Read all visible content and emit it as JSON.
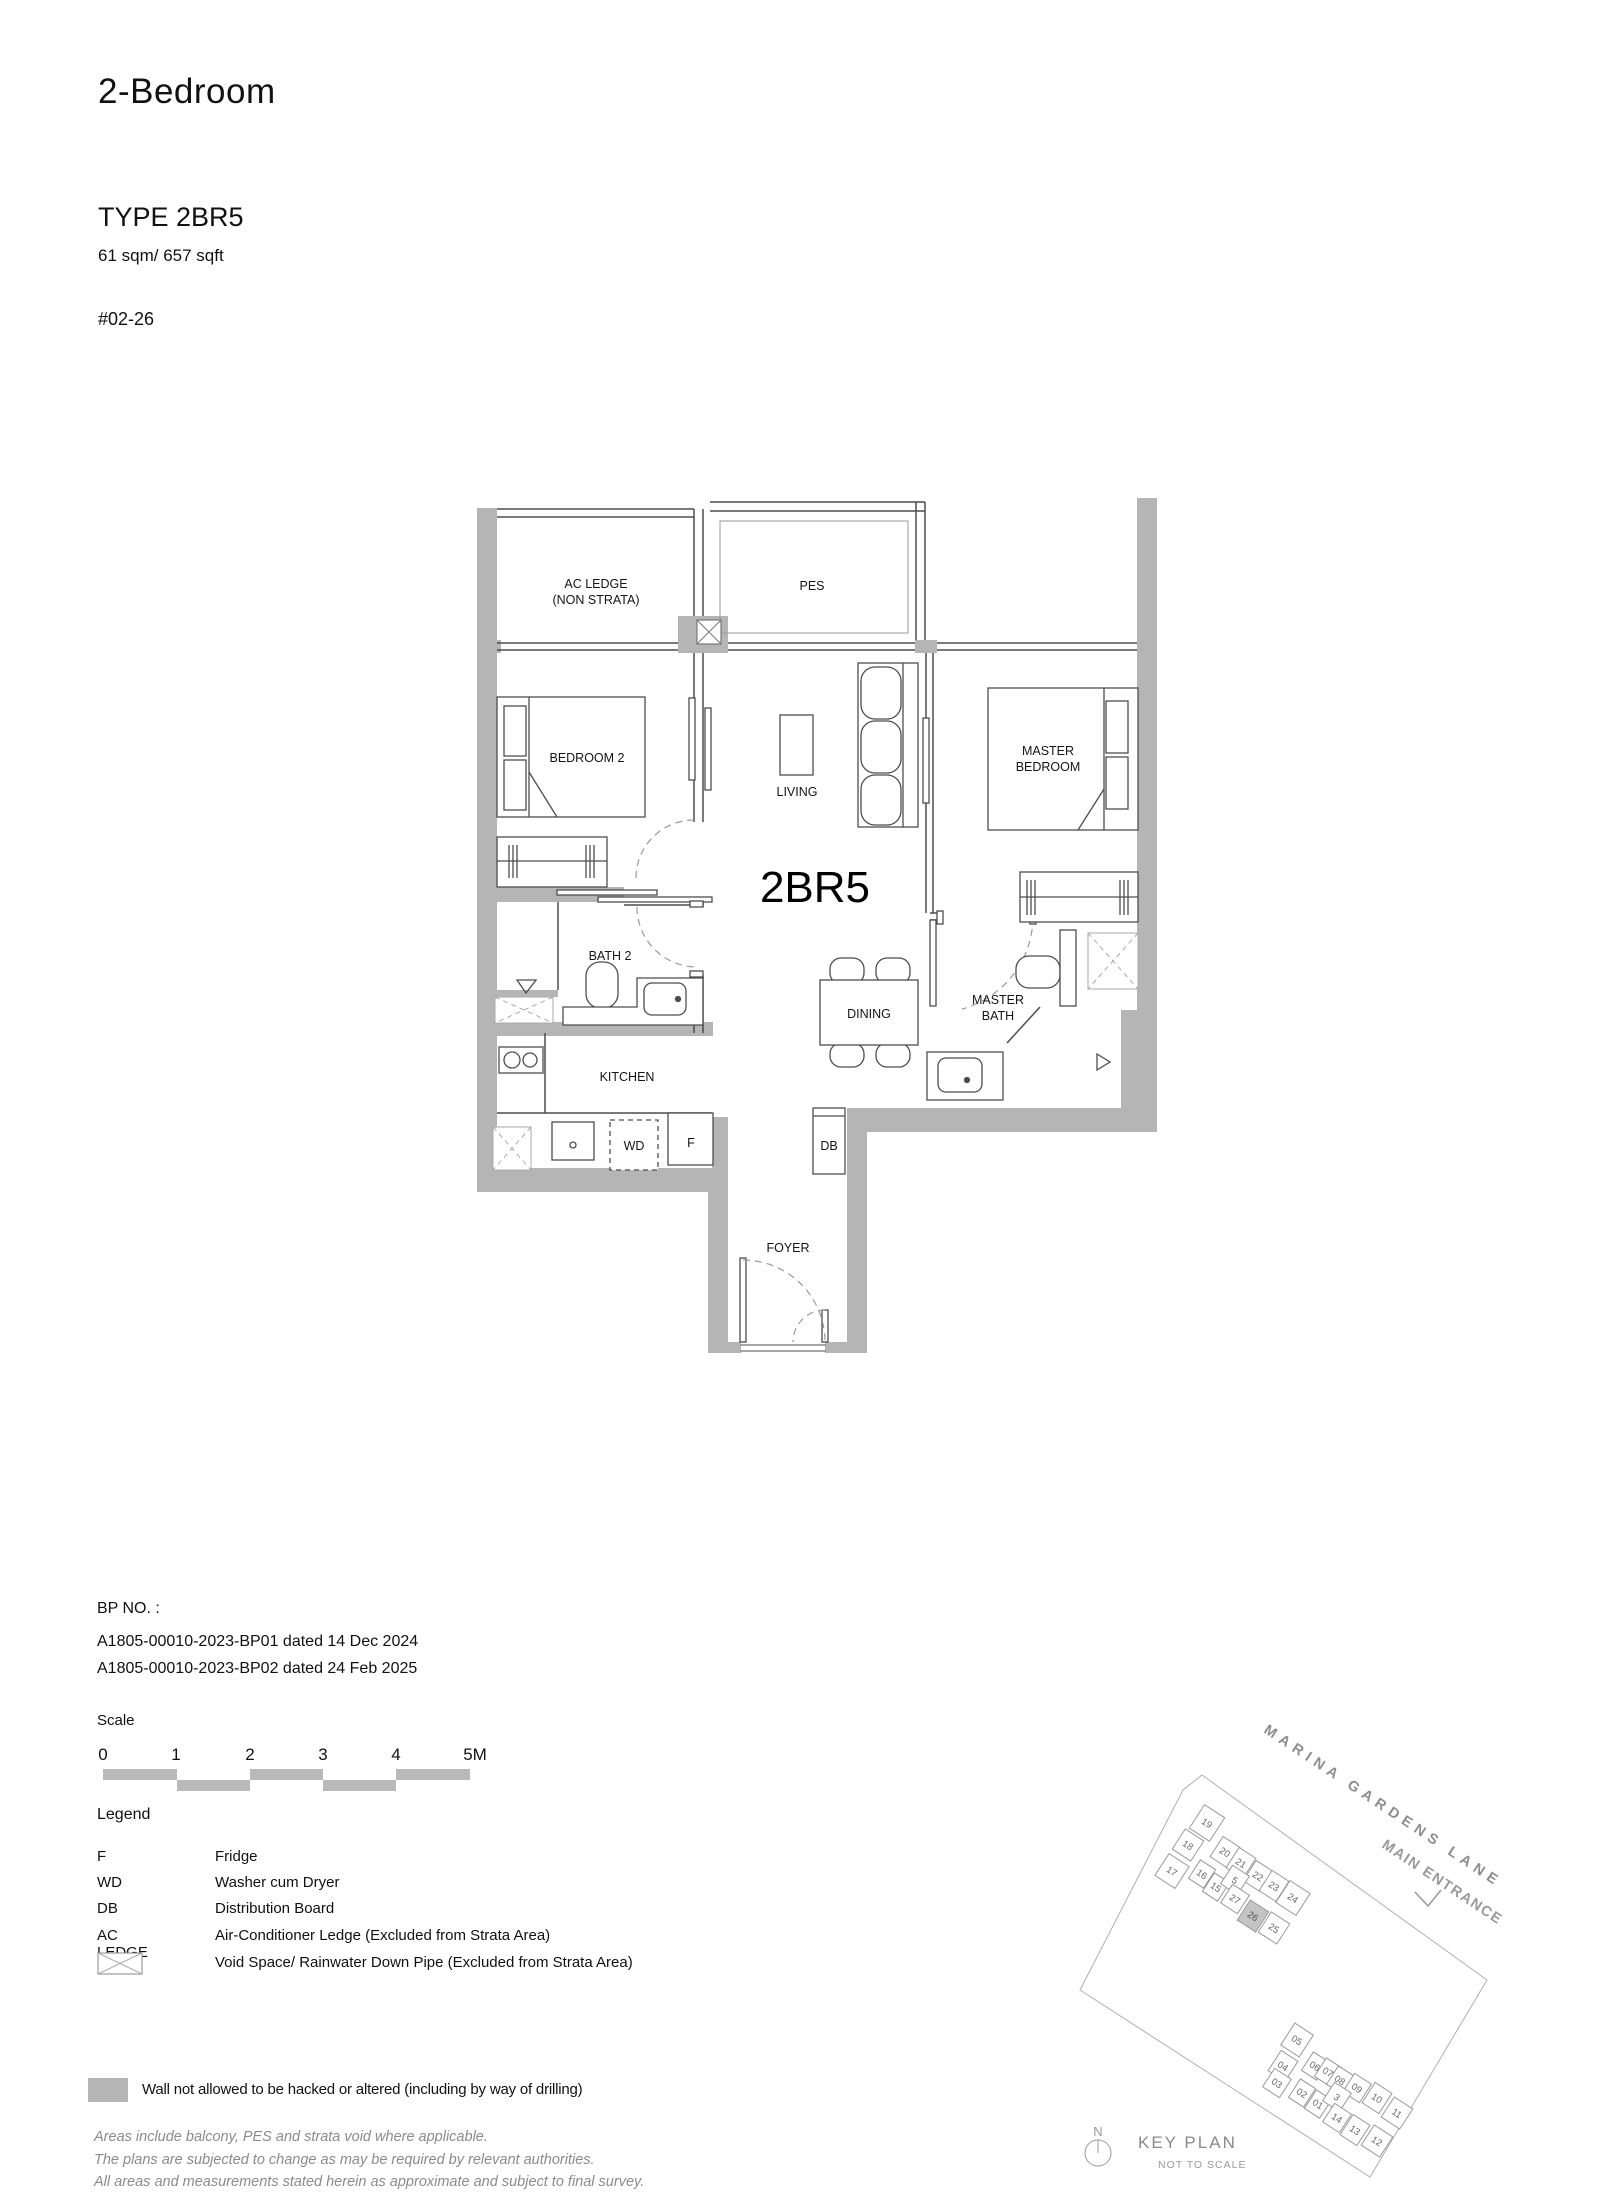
{
  "header": {
    "category": "2-Bedroom",
    "type_label": "TYPE 2BR5",
    "area": "61 sqm/ 657 sqft",
    "unit_no": "#02-26"
  },
  "floorplan": {
    "plan_label": "2BR5",
    "labels": {
      "ac_ledge_1": "AC LEDGE",
      "ac_ledge_2": "(NON STRATA)",
      "pes": "PES",
      "bedroom2": "BEDROOM 2",
      "living": "LIVING",
      "master_1": "MASTER",
      "master_2": "BEDROOM",
      "bath2": "BATH 2",
      "dining": "DINING",
      "master_bath_1": "MASTER",
      "master_bath_2": "BATH",
      "kitchen": "KITCHEN",
      "wd": "WD",
      "fridge": "F",
      "db": "DB",
      "foyer": "FOYER"
    }
  },
  "bp": {
    "heading": "BP NO. :",
    "lines": [
      "A1805-00010-2023-BP01 dated 14 Dec 2024",
      "A1805-00010-2023-BP02 dated 24 Feb 2025"
    ]
  },
  "scale": {
    "heading": "Scale",
    "ticks": [
      "0",
      "1",
      "2",
      "3",
      "4",
      "5M"
    ]
  },
  "legend": {
    "heading": "Legend",
    "items": [
      {
        "term": "F",
        "desc": "Fridge"
      },
      {
        "term": "WD",
        "desc": "Washer cum Dryer"
      },
      {
        "term": "DB",
        "desc": "Distribution Board"
      },
      {
        "term": "AC LEDGE",
        "desc": "Air-Conditioner Ledge (Excluded from Strata Area)"
      },
      {
        "term": "",
        "desc": "Void Space/ Rainwater Down Pipe (Excluded from Strata Area)",
        "icon": "void-space-icon"
      }
    ]
  },
  "wall_note": "Wall not allowed to be hacked or altered (including by way of drilling)",
  "disclaimer": {
    "lines": [
      "Areas include balcony, PES and strata void where applicable.",
      "The plans are subjected to change as may be required by relevant authorities.",
      "All areas and measurements stated herein as approximate and subject to final survey."
    ]
  },
  "keyplan": {
    "street": "MARINA GARDENS LANE",
    "entrance": "MAIN ENTRANCE",
    "title": "KEY PLAN",
    "subtitle": "NOT TO SCALE",
    "north": "N",
    "highlighted_unit": "26",
    "units": [
      "19",
      "18",
      "17",
      "20",
      "21",
      "22",
      "23",
      "24",
      "16",
      "15",
      "5",
      "27",
      "26",
      "25",
      "05",
      "04",
      "03",
      "06",
      "07",
      "08",
      "09",
      "10",
      "11",
      "02",
      "01",
      "3",
      "14",
      "13",
      "12"
    ]
  },
  "colors": {
    "wall_no_hack": "#b5b5b5",
    "plan_line": "#4d4d4d",
    "keyplan_line": "#9a9a9a"
  }
}
